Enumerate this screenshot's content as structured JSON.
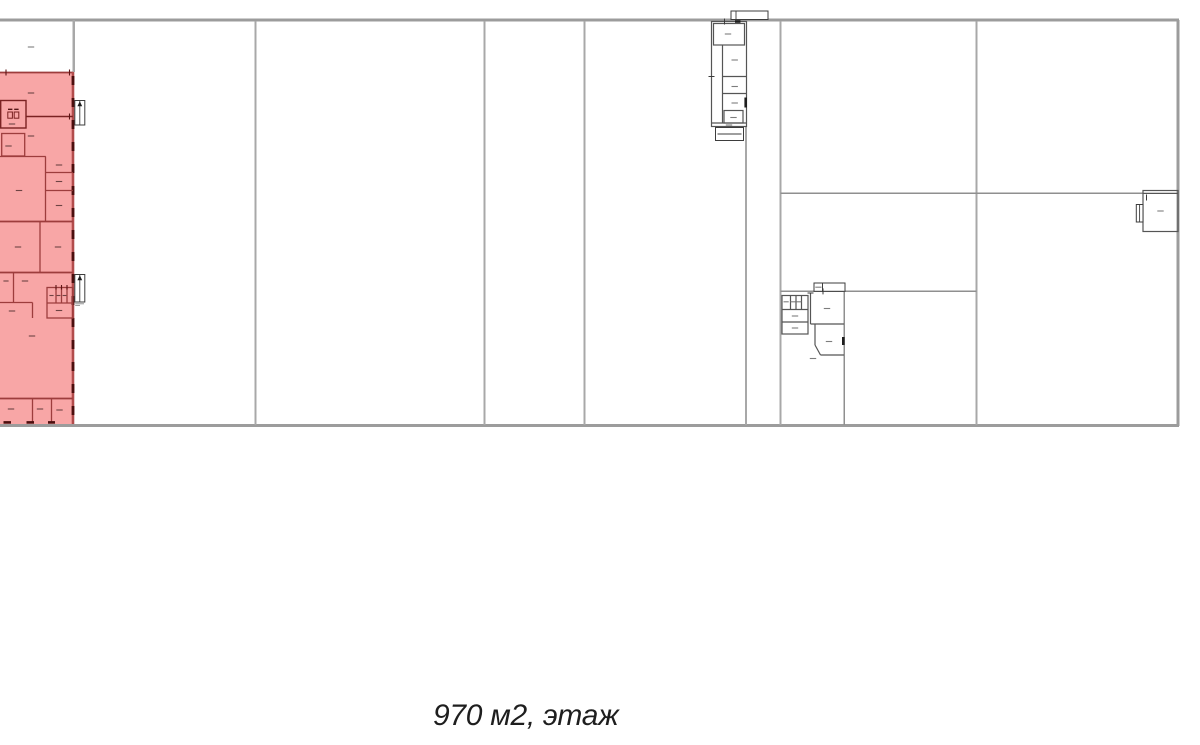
{
  "caption": {
    "text": "970 м2, этаж"
  },
  "plan": {
    "colors": {
      "background": "#ffffff",
      "caption_color": "#1e1e1e",
      "boundary": "#9c9c9c",
      "divider": "#a8a8a8",
      "divider_thin": "#8f8f8f",
      "wall": "#555555",
      "stairs": "#3d3d3d",
      "marker": "#7d7d7d",
      "marker_highlight": "#6e4444",
      "highlight_fill": "#f8a6a6",
      "highlight_wall": "#9d3d3d",
      "highlight_wall_dark": "#7a2222",
      "highlight_edge": "#b24c4c",
      "opening_dark": "#4c0e0e"
    }
  }
}
